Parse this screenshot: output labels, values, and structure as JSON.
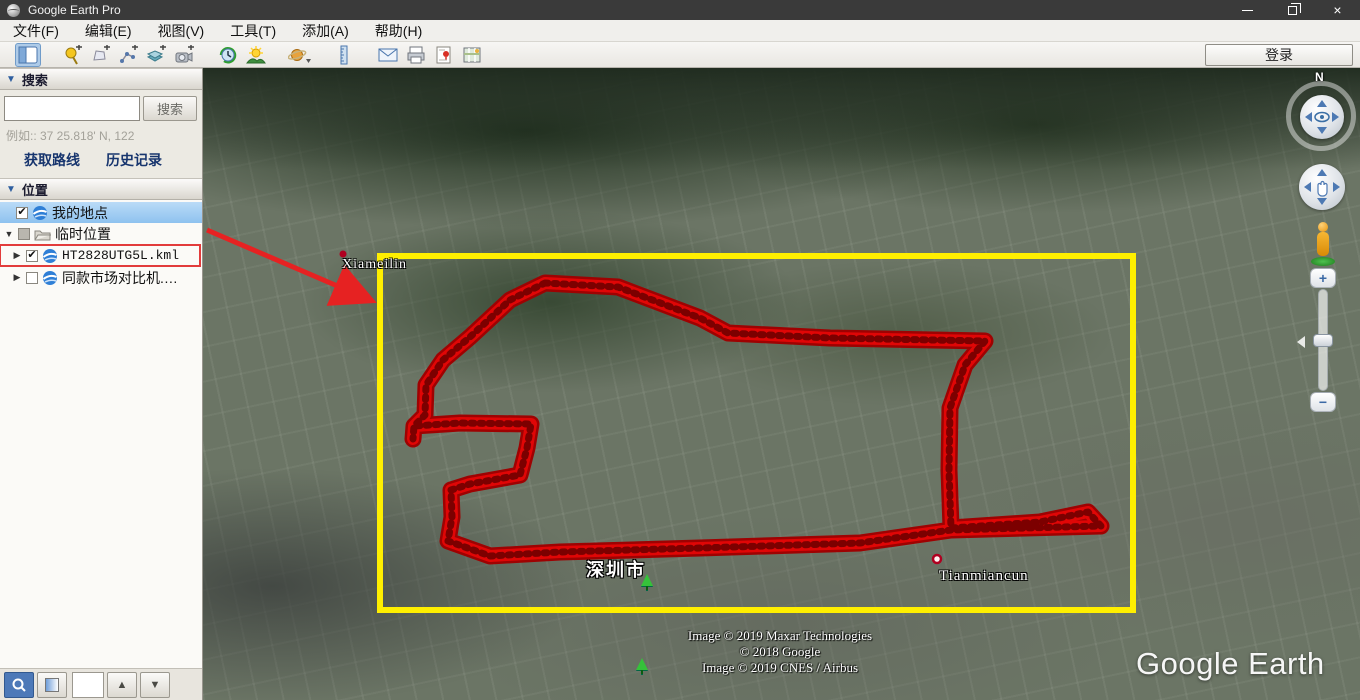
{
  "window": {
    "title": "Google Earth Pro",
    "controls": [
      "minimize-icon",
      "restore-icon",
      "close-icon"
    ]
  },
  "menu": {
    "items": [
      "文件(F)",
      "编辑(E)",
      "视图(V)",
      "工具(T)",
      "添加(A)",
      "帮助(H)"
    ]
  },
  "toolbar": {
    "sign_in": "登录",
    "icons": [
      "sidebar-toggle-icon",
      "add-placemark-icon",
      "add-polygon-icon",
      "add-path-icon",
      "add-image-overlay-icon",
      "record-tour-icon",
      "historical-imagery-icon",
      "sunlight-icon",
      "planets-icon",
      "ruler-icon",
      "email-icon",
      "print-icon",
      "save-image-icon",
      "view-in-maps-icon"
    ]
  },
  "search": {
    "title": "搜索",
    "button": "搜索",
    "input_value": "",
    "example": "例如:: 37 25.818' N, 122",
    "routes_link": "获取路线",
    "history_link": "历史记录"
  },
  "places": {
    "title": "位置",
    "items": [
      {
        "label": "我的地点",
        "checked": "✔",
        "selected": true
      },
      {
        "label": "临时位置",
        "checked": "",
        "state": "partial",
        "expander": "▼"
      },
      {
        "label": "HT2828UTG5L.kml",
        "checked": "✔",
        "expander": "▶",
        "red_box": true
      },
      {
        "label": "同款市场对比机.…",
        "checked": "",
        "expander": "▶"
      }
    ]
  },
  "sidebar_footer": {
    "buttons": [
      "search-results-icon",
      "globe-square-icon",
      "blank-box",
      "up-arrow-icon",
      "down-arrow-icon"
    ],
    "up_glyph": "▲",
    "down_glyph": "▼"
  },
  "map": {
    "place_labels": [
      "Xiameilin",
      "深圳市",
      "Tianmiancun"
    ],
    "copyright": [
      "Image © 2019 Maxar Technologies",
      "© 2018 Google",
      "Image © 2019 CNES / Airbus"
    ],
    "watermark": "Google Earth",
    "compass": "N",
    "zoom_plus": "+",
    "zoom_minus": "−"
  },
  "annotations": {
    "gps_track_color": "#d60404",
    "highlight_rect_color": "#ffef00",
    "callout_arrow_color": "#e62222",
    "kml_item_box_color": "#e23b3b"
  }
}
